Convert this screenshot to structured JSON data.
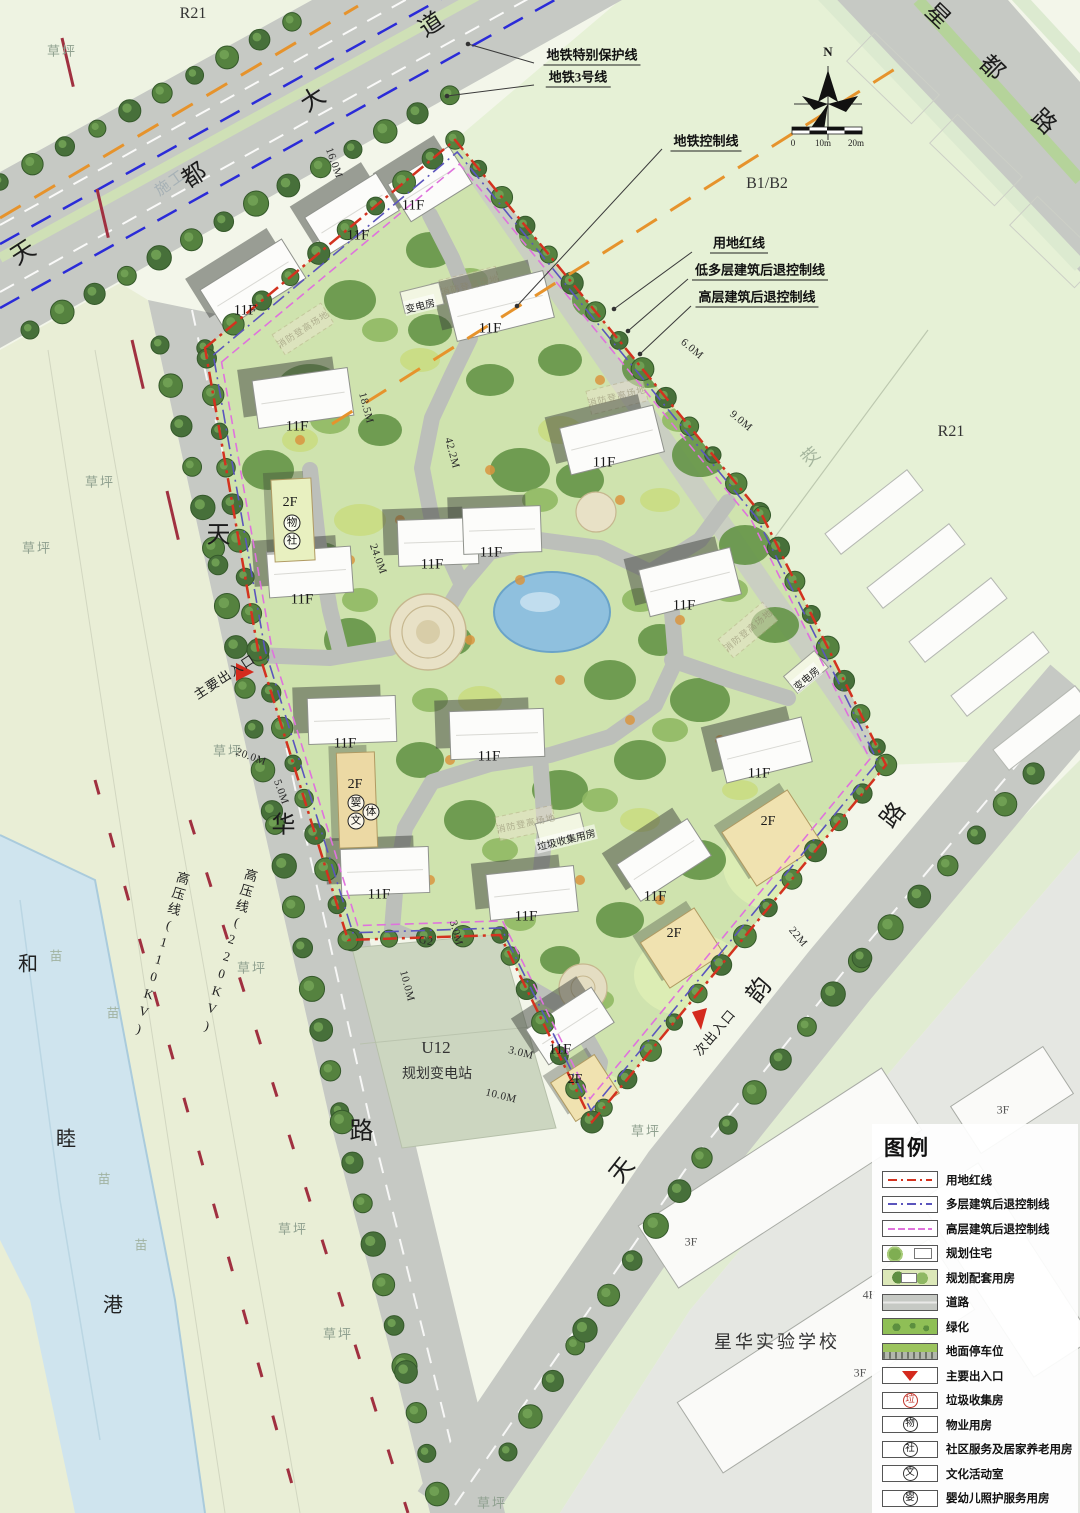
{
  "map": {
    "roads": {
      "tiandu_avenue": [
        "天",
        "都",
        "大",
        "道"
      ],
      "xingdu_road": [
        "星",
        "都",
        "路"
      ],
      "tianhua_road": [
        "天",
        "华",
        "路"
      ],
      "tianyun_road": [
        "天",
        "韵",
        "路"
      ],
      "hemu_river": [
        "和",
        "睦",
        "港"
      ]
    },
    "callouts": {
      "metro_protect": "地铁特别保护线",
      "metro_line3": "地铁3号线",
      "metro_control": "地铁控制线",
      "red_line": "用地红线",
      "low_multi_setback": "低多层建筑后退控制线",
      "highrise_setback": "高层建筑后退控制线"
    },
    "zones": {
      "r21_top": "R21",
      "r21_right": "R21",
      "b1b2": "B1/B2",
      "jiao": "茭",
      "u12_code": "U12",
      "u12_name": "规划变电站",
      "school": "星华实验学校",
      "construction": "施工"
    },
    "ground": {
      "lawn": "草坪",
      "nursery": "苗"
    },
    "power": {
      "hv220": "高压线(220KV)",
      "hv110": "高压线(110KV)"
    },
    "entrances": {
      "main": "主要出入口",
      "secondary": "次出入口"
    },
    "buildings": {
      "f11": "11F",
      "f2": "2F",
      "f3": "3F",
      "f4": "4F",
      "substation": "变电房",
      "garbage": "垃圾收集用房",
      "fire_pad": "消防登高场地"
    },
    "amenities": {
      "property": "物",
      "community": "社",
      "infant": "婴",
      "culture": "文",
      "sports": "体"
    },
    "dims": {
      "d24": "24.0M",
      "d20": "20.0M",
      "d5": "5.0M",
      "d6": "6.0M",
      "d9": "9.0M",
      "d3": "3.0M",
      "d10": "10.0M",
      "d22": "22M",
      "g2": "G2",
      "d42": "42.2M",
      "d18": "18.5M",
      "d16": "16.0M"
    },
    "compass": {
      "north": "N"
    },
    "scale": {
      "zero": "0",
      "ten": "10m",
      "twenty": "20m"
    }
  },
  "legend": {
    "title": "图例",
    "items": [
      {
        "label": "用地红线"
      },
      {
        "label": "多层建筑后退控制线"
      },
      {
        "label": "高层建筑后退控制线"
      },
      {
        "label": "规划住宅"
      },
      {
        "label": "规划配套用房"
      },
      {
        "label": "道路"
      },
      {
        "label": "绿化"
      },
      {
        "label": "地面停车位"
      },
      {
        "label": "主要出入口"
      },
      {
        "label": "垃圾收集房",
        "glyph": "垃"
      },
      {
        "label": "物业用房",
        "glyph": "物"
      },
      {
        "label": "社区服务及居家养老用房",
        "glyph": "社"
      },
      {
        "label": "文化活动室",
        "glyph": "文"
      },
      {
        "label": "婴幼儿照护服务用房",
        "glyph": "婴"
      },
      {
        "label": "体育活动室",
        "glyph": "体"
      }
    ]
  },
  "colors": {
    "red_line": "#d3321f",
    "metro_blue": "#2b2bd8",
    "control_orange": "#e6932c",
    "setback_pink": "#df72dd",
    "setback_purple": "#5b55bd",
    "water": "#8fc0de",
    "greenery": "#8fbf56",
    "road_gray": "#c6c9c4",
    "entrance_red": "#d42a1e"
  }
}
